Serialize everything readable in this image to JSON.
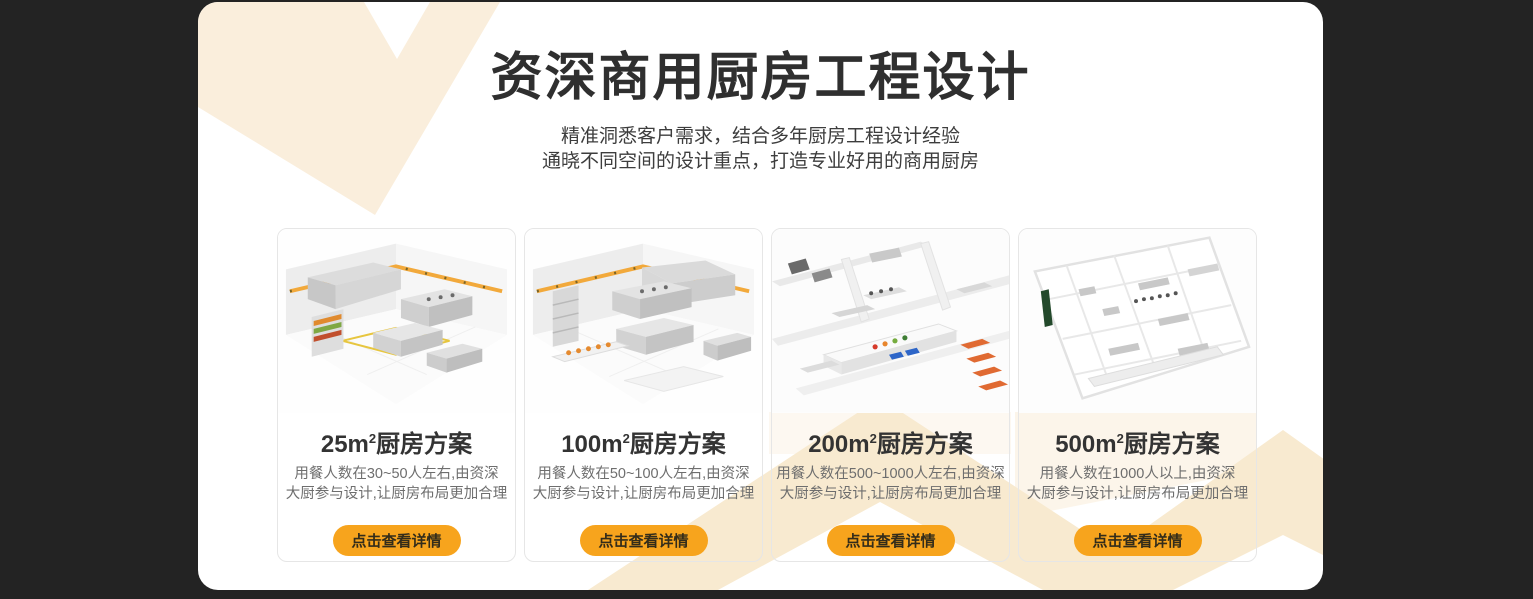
{
  "theme": {
    "background": "#232323",
    "panel": "#FFFFFF",
    "accent_orange": "#F7A41D",
    "decor_cream": "#F8EAD0",
    "decor_cream_soft": "#FBF2E3",
    "card_border": "#E6E6E6",
    "title_color": "#2F2F2F",
    "desc_color": "#6E6E6E",
    "button_text_color": "#332C1A"
  },
  "header": {
    "title": "资深商用厨房工程设计",
    "subtitle_line1": "精准洞悉客户需求，结合多年厨房工程设计经验",
    "subtitle_line2": "通晓不同空间的设计重点，打造专业好用的商用厨房"
  },
  "cards": [
    {
      "title_base": "25m",
      "title_sup": "2",
      "title_rest": "厨房方案",
      "desc_line1": "用餐人数在30~50人左右,由资深",
      "desc_line2": "大厨参与设计,让厨房布局更加合理",
      "button_label": "点击查看详情"
    },
    {
      "title_base": "100m",
      "title_sup": "2",
      "title_rest": "厨房方案",
      "desc_line1": "用餐人数在50~100人左右,由资深",
      "desc_line2": "大厨参与设计,让厨房布局更加合理",
      "button_label": "点击查看详情"
    },
    {
      "title_base": "200m",
      "title_sup": "2",
      "title_rest": "厨房方案",
      "desc_line1": "用餐人数在500~1000人左右,由资深",
      "desc_line2": "大厨参与设计,让厨房布局更加合理",
      "button_label": "点击查看详情"
    },
    {
      "title_base": "500m",
      "title_sup": "2",
      "title_rest": "厨房方案",
      "desc_line1": "用餐人数在1000人以上,由资深",
      "desc_line2": "大厨参与设计,让厨房布局更加合理",
      "button_label": "点击查看详情"
    }
  ]
}
